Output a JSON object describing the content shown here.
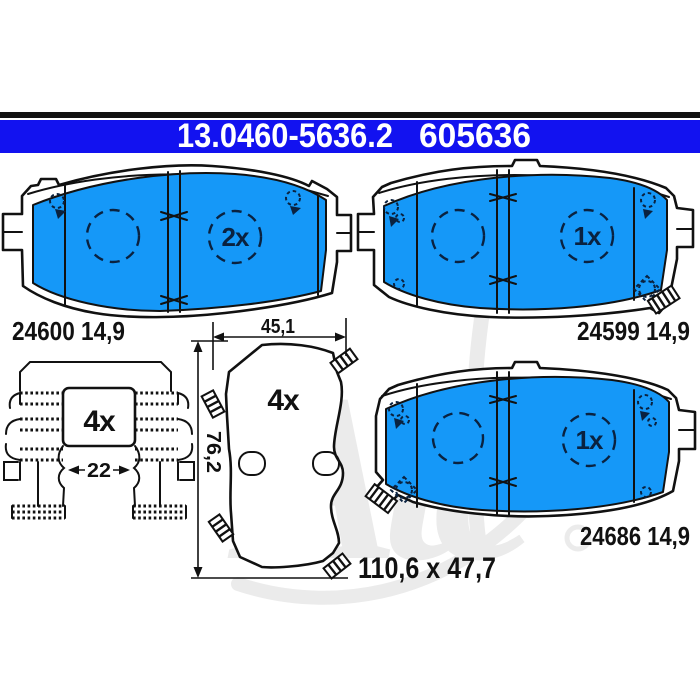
{
  "header": {
    "part_number": "13.0460-5636.2",
    "reference_number": "605636"
  },
  "pads": {
    "top_left": {
      "quantity": "2x",
      "part_label": "24600 14,9"
    },
    "top_right": {
      "quantity": "1x",
      "part_label": "24599 14,9"
    },
    "bottom_right": {
      "quantity": "1x",
      "part_label": "24686 14,9"
    }
  },
  "backplate": {
    "quantity": "4x",
    "width_mm": "45,1",
    "height_mm": "76,2",
    "overall_size": "110,6 x 47,7"
  },
  "fitting_kit": {
    "quantity": "4x",
    "gap_mm": "22"
  },
  "watermark": {
    "brand": "Ate"
  },
  "colors": {
    "header_bar": "#1212f0",
    "header_text": "#ffffff",
    "pad_fill": "#1598f8",
    "outline": "#111111",
    "detail": "#0a2240",
    "watermark": "#ebebeb"
  }
}
